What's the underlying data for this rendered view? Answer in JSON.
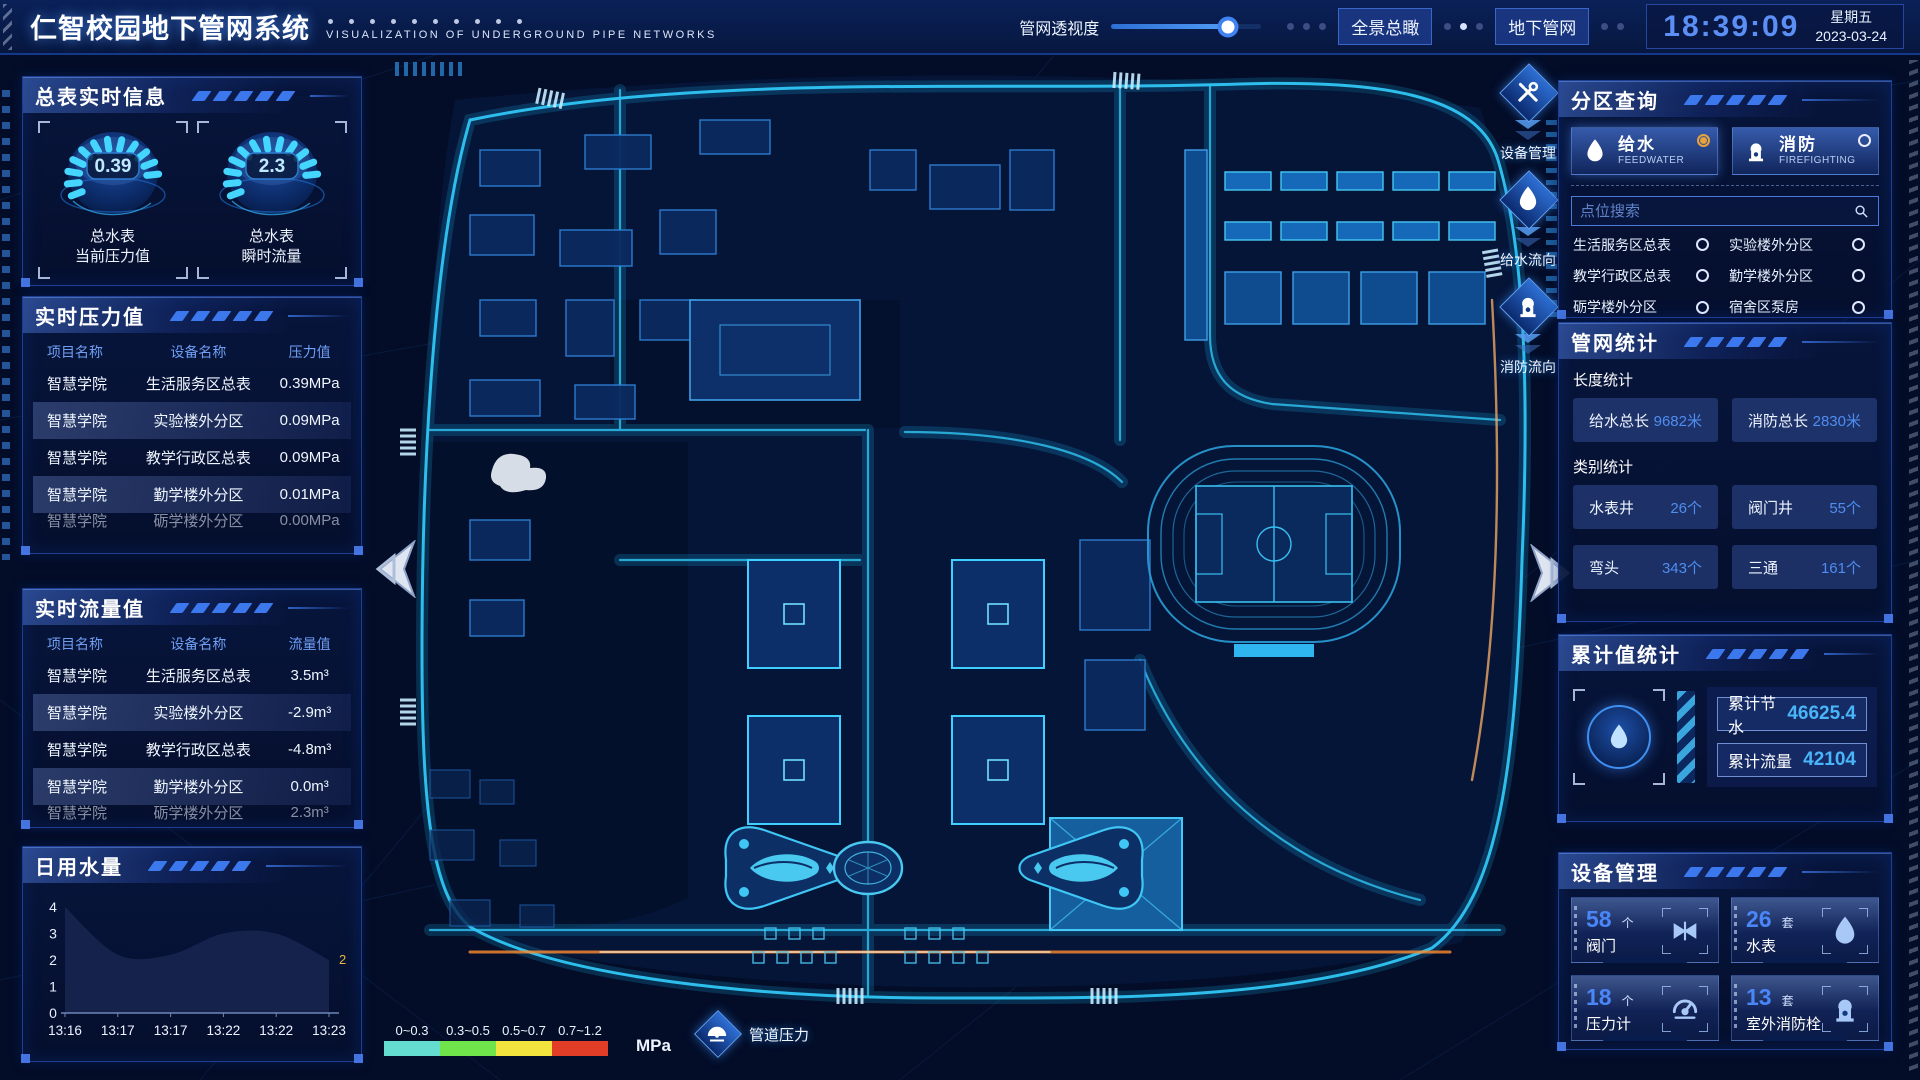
{
  "header": {
    "title": "仁智校园地下管网系统",
    "subtitle": "VISUALIZATION OF UNDERGROUND PIPE NETWORKS",
    "slider": {
      "label": "管网透视度",
      "value": 78
    },
    "buttons": [
      {
        "label": "全景总瞰"
      },
      {
        "label": "地下管网"
      }
    ],
    "clock": {
      "time": "18:39:09",
      "weekday": "星期五",
      "date": "2023-03-24"
    }
  },
  "left": {
    "meter_panel": {
      "title": "总表实时信息",
      "gauges": [
        {
          "value": "0.39",
          "label_lines": [
            "总水表",
            "当前压力值"
          ]
        },
        {
          "value": "2.3",
          "label_lines": [
            "总水表",
            "瞬时流量"
          ]
        }
      ]
    },
    "pressure_panel": {
      "title": "实时压力值",
      "columns": [
        "项目名称",
        "设备名称",
        "压力值"
      ],
      "rows": [
        [
          "智慧学院",
          "生活服务区总表",
          "0.39MPa"
        ],
        [
          "智慧学院",
          "实验楼外分区",
          "0.09MPa"
        ],
        [
          "智慧学院",
          "教学行政区总表",
          "0.09MPa"
        ],
        [
          "智慧学院",
          "勤学楼外分区",
          "0.01MPa"
        ],
        [
          "智慧学院",
          "砺学楼外分区",
          "0.00MPa"
        ]
      ]
    },
    "flow_panel": {
      "title": "实时流量值",
      "columns": [
        "项目名称",
        "设备名称",
        "流量值"
      ],
      "rows": [
        [
          "智慧学院",
          "生活服务区总表",
          "3.5m³"
        ],
        [
          "智慧学院",
          "实验楼外分区",
          "-2.9m³"
        ],
        [
          "智慧学院",
          "教学行政区总表",
          "-4.8m³"
        ],
        [
          "智慧学院",
          "勤学楼外分区",
          "0.0m³"
        ],
        [
          "智慧学院",
          "砺学楼外分区",
          "2.3m³"
        ]
      ]
    }
  },
  "chart_data": {
    "type": "area",
    "title": "日用水量",
    "x": [
      "13:16",
      "13:17",
      "13:17",
      "13:22",
      "13:22",
      "13:23"
    ],
    "values": [
      4,
      2.2,
      2.2,
      3,
      3,
      2
    ],
    "ylim": [
      0,
      4
    ],
    "yticks": [
      0,
      1,
      2,
      3,
      4
    ],
    "end_label": "2",
    "end_label_color": "#e8b93c",
    "area_color": "#16244d",
    "grid": false,
    "legend": "none"
  },
  "right": {
    "zone_panel": {
      "title": "分区查询",
      "tabs": [
        {
          "label": "给水",
          "sub": "FEEDWATER",
          "icon": "water-drop-icon",
          "selected": true
        },
        {
          "label": "消防",
          "sub": "FIREFIGHTING",
          "icon": "hydrant-icon",
          "selected": false
        }
      ],
      "search_placeholder": "点位搜索",
      "options": [
        "生活服务区总表",
        "实验楼外分区",
        "教学行政区总表",
        "勤学楼外分区",
        "砺学楼外分区",
        "宿舍区泵房"
      ]
    },
    "stats_panel": {
      "title": "管网统计",
      "length_label": "长度统计",
      "length_stats": [
        {
          "label": "给水总长",
          "value": "9682米"
        },
        {
          "label": "消防总长",
          "value": "2830米"
        }
      ],
      "category_label": "类别统计",
      "category_stats": [
        {
          "label": "水表井",
          "value": "26个"
        },
        {
          "label": "阀门井",
          "value": "55个"
        },
        {
          "label": "弯头",
          "value": "343个"
        },
        {
          "label": "三通",
          "value": "161个"
        },
        {
          "label": "",
          "value": ""
        },
        {
          "label": "",
          "value": ""
        }
      ]
    },
    "cumulative_panel": {
      "title": "累计值统计",
      "items": [
        {
          "label": "累计节水",
          "value": "46625.4"
        },
        {
          "label": "累计流量",
          "value": "42104"
        }
      ]
    },
    "device_panel": {
      "title": "设备管理",
      "cards": [
        {
          "count": "58",
          "unit": "个",
          "label": "阀门",
          "icon": "valve-icon"
        },
        {
          "count": "26",
          "unit": "套",
          "label": "水表",
          "icon": "water-drop-icon"
        },
        {
          "count": "18",
          "unit": "个",
          "label": "压力计",
          "icon": "pressure-gauge-icon"
        },
        {
          "count": "13",
          "unit": "套",
          "label": "室外消防栓",
          "icon": "hydrant-icon"
        }
      ]
    }
  },
  "map": {
    "tools": [
      {
        "label": "设备管理",
        "icon": "wrench-icon"
      },
      {
        "label": "给水流向",
        "icon": "water-drop-icon"
      },
      {
        "label": "消防流向",
        "icon": "hydrant-icon"
      }
    ],
    "legend": {
      "ranges": [
        {
          "label": "0~0.3",
          "color": "#64dcd0"
        },
        {
          "label": "0.3~0.5",
          "color": "#70e44b"
        },
        {
          "label": "0.5~0.7",
          "color": "#f2e33f"
        },
        {
          "label": "0.7~1.2",
          "color": "#e23d27"
        }
      ],
      "unit": "MPa",
      "pressure_label": "管道压力"
    }
  }
}
